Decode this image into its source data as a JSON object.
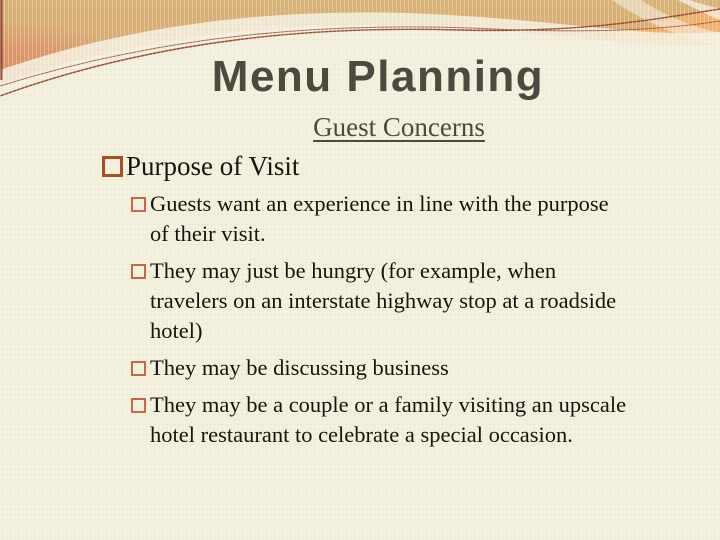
{
  "slide": {
    "title": "Menu Planning",
    "subtitle": "Guest Concerns",
    "content": {
      "level1": "Purpose of Visit",
      "items": [
        "Guests want an experience in line with the purpose\nof their visit.",
        "They may just be hungry (for example, when\ntravelers on an interstate highway stop at a roadside\nhotel)",
        "They may be discussing business",
        "They may be a couple or a family visiting an upscale\nhotel restaurant to celebrate a special occasion."
      ]
    },
    "colors": {
      "background_cream": "#F2EFDC",
      "banner_tan": "#D7B277",
      "banner_orange": "#E09467",
      "swoosh_band_orange": "#ECA763",
      "accent_line_maroon": "#8E3B26",
      "title_text": "#4B4A41",
      "body_text": "#16140E",
      "bullet_level1_border": "#A3502D",
      "bullet_level2_border": "#C16A4B"
    }
  }
}
